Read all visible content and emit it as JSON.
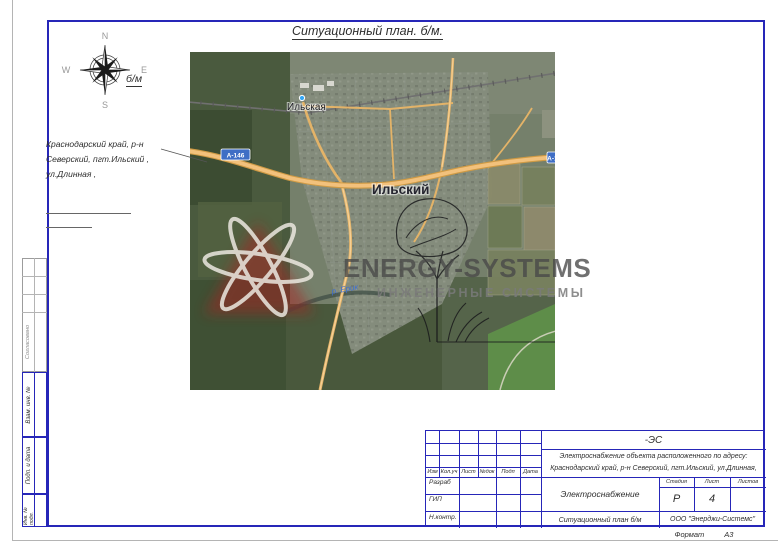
{
  "doc": {
    "title": "Ситуационный план. б/м.",
    "scale_label": "б/м",
    "format_label": "Формат",
    "format_value": "А3"
  },
  "compass": {
    "north": "N",
    "east": "E",
    "south": "S",
    "west": "W"
  },
  "address_note": {
    "line1": "Краснодарский край, р-н",
    "line2": "Северский, пгт.Ильский ,",
    "line3": "ул.Длинная , "
  },
  "map": {
    "station_label": "Ильская",
    "town_label": "Ильский",
    "road_badge": "А-146",
    "river_label": "р. Ерик",
    "watermark_title": "ENERGY-SYSTEMS",
    "watermark_subtitle": "ИНЖЕНЕРНЫЕ СИСТЕМЫ"
  },
  "side_panel": {
    "agreed": "Согласовано",
    "vzam_inv": "Взам. инв. №",
    "podp_data": "Подп. и дата",
    "inv_podl": "Инв. № подл."
  },
  "stamp": {
    "doc_code": "-ЭС",
    "object_line1": "Электроснабжение объекта расположенного по адресу:",
    "object_line2": "Краснодарский край, р-н Северский, пгт.Ильский, ул.Длинная,",
    "rev_headers": [
      "Изм",
      "Кол.уч",
      "Лист",
      "№док",
      "Подп",
      "Дата"
    ],
    "roles": [
      "Разраб",
      "ГИП",
      "Н.контр."
    ],
    "system_title": "Электроснабжение",
    "sheet_title": "Ситуационный план б/м",
    "stage_headers": [
      "Стадия",
      "Лист",
      "Листов"
    ],
    "stage_value": "Р",
    "sheet_value": "4",
    "sheets_total_value": "",
    "org_name": "ООО \"Энерджи-Системс\""
  },
  "colors": {
    "frame_blue": "#2626b8",
    "road_orange": "#e8a94f",
    "badge_blue": "#3f6ec5",
    "logo_red": "#a82020"
  }
}
